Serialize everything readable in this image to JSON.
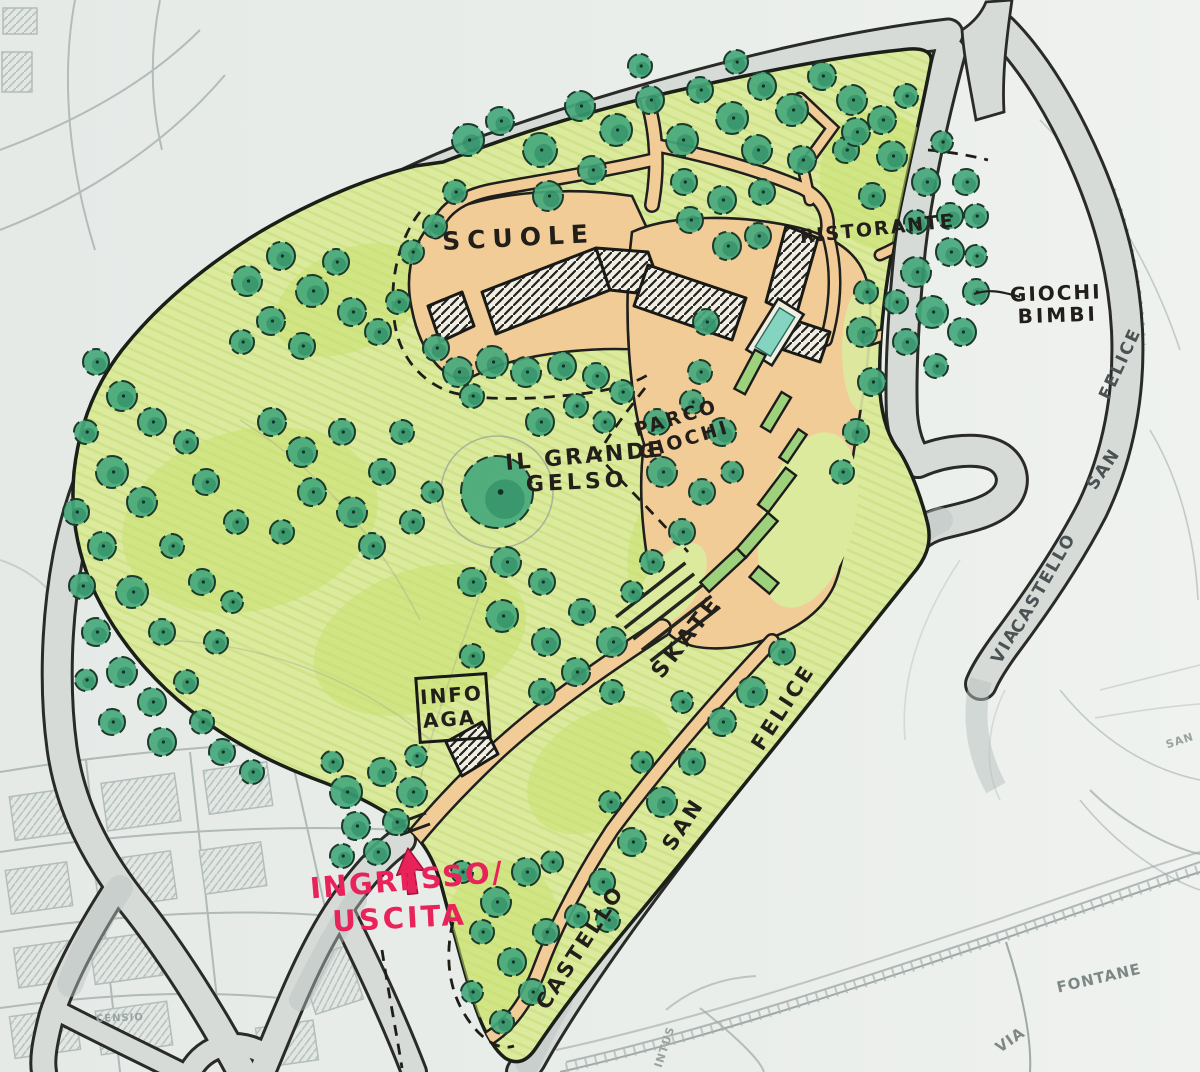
{
  "document": {
    "kind": "hand-drawn park masterplan sketch"
  },
  "palette": {
    "paper": "#e9ede9",
    "basemap_line": "#b2bcba",
    "road_fill": "#d6dbd8",
    "road_stroke": "#2a2a27",
    "park_lawn": "#dcea9e",
    "lawn_bright": "#c9e070",
    "tree_green": "#47a87c",
    "tree_dark": "#1f7f5b",
    "tree_outline": "#1c3a2b",
    "path_tan": "#f2cc97",
    "pool_teal": "#84d4c0",
    "ink": "#221f1a",
    "pencil": "#4a5254",
    "faint": "#7d8886",
    "fainter": "#98a3a0",
    "red": "#e7235a"
  },
  "labels": [
    {
      "id": "scuole",
      "text": "SCUOLE",
      "x": 519,
      "y": 246,
      "rot": -3,
      "size": 25,
      "ls": 7,
      "color": "ink"
    },
    {
      "id": "ristorante",
      "text": "RISTORANTE",
      "x": 878,
      "y": 235,
      "rot": -6,
      "size": 19,
      "ls": 2,
      "color": "ink"
    },
    {
      "id": "giochi-bimbi-line1",
      "text": "GIOCHI",
      "x": 1056,
      "y": 300,
      "rot": -2,
      "size": 20,
      "ls": 2,
      "color": "ink"
    },
    {
      "id": "giochi-bimbi-line2",
      "text": "BIMBI",
      "x": 1058,
      "y": 322,
      "rot": -2,
      "size": 20,
      "ls": 3,
      "color": "ink"
    },
    {
      "id": "parco-giochi-line1",
      "text": "PARCO",
      "x": 678,
      "y": 424,
      "rot": -17,
      "size": 19,
      "ls": 3,
      "color": "ink"
    },
    {
      "id": "parco-giochi-line2",
      "text": "GIOCHI",
      "x": 686,
      "y": 446,
      "rot": -17,
      "size": 19,
      "ls": 3,
      "color": "ink"
    },
    {
      "id": "il-grande-gelso-line1",
      "text": "IL GRANDE",
      "x": 586,
      "y": 463,
      "rot": -5,
      "size": 22,
      "ls": 3,
      "color": "ink"
    },
    {
      "id": "il-grande-gelso-line2",
      "text": "GELSO",
      "x": 577,
      "y": 489,
      "rot": -3,
      "size": 22,
      "ls": 4,
      "color": "ink"
    },
    {
      "id": "skate",
      "text": "SKATE",
      "x": 692,
      "y": 641,
      "rot": -52,
      "size": 22,
      "ls": 4,
      "color": "ink"
    },
    {
      "id": "info-aga-line1",
      "text": "INFO",
      "x": 452,
      "y": 702,
      "rot": -4,
      "size": 20,
      "ls": 2,
      "color": "ink"
    },
    {
      "id": "info-aga-line2",
      "text": "AGA",
      "x": 450,
      "y": 726,
      "rot": -4,
      "size": 20,
      "ls": 2,
      "color": "ink"
    },
    {
      "id": "ingresso",
      "text": "INGRESSO/",
      "x": 408,
      "y": 890,
      "rot": -5,
      "size": 29,
      "ls": 2,
      "color": "red"
    },
    {
      "id": "uscita",
      "text": "USCITA",
      "x": 400,
      "y": 928,
      "rot": -3,
      "size": 29,
      "ls": 3,
      "color": "red"
    },
    {
      "id": "road-castello",
      "text": "CASTELLO",
      "x": 586,
      "y": 951,
      "rot": -57,
      "size": 21,
      "ls": 3,
      "color": "ink"
    },
    {
      "id": "road-san",
      "text": "SAN",
      "x": 689,
      "y": 828,
      "rot": -57,
      "size": 21,
      "ls": 3,
      "color": "ink"
    },
    {
      "id": "road-felice",
      "text": "FELICE",
      "x": 789,
      "y": 711,
      "rot": -57,
      "size": 21,
      "ls": 3,
      "color": "ink"
    },
    {
      "id": "via-right",
      "text": "VIA",
      "x": 1010,
      "y": 648,
      "rot": -60,
      "size": 17,
      "ls": 2,
      "color": "pencil"
    },
    {
      "id": "castello-right",
      "text": "CASTELLO",
      "x": 1048,
      "y": 586,
      "rot": -60,
      "size": 17,
      "ls": 2,
      "color": "pencil"
    },
    {
      "id": "san-right",
      "text": "SAN",
      "x": 1108,
      "y": 472,
      "rot": -56,
      "size": 17,
      "ls": 2,
      "color": "pencil"
    },
    {
      "id": "felice-right",
      "text": "FELICE",
      "x": 1125,
      "y": 366,
      "rot": -65,
      "size": 17,
      "ls": 2,
      "color": "pencil"
    },
    {
      "id": "via-fontane-word1",
      "text": "VIA",
      "x": 1013,
      "y": 1044,
      "rot": -35,
      "size": 15,
      "ls": 1,
      "color": "faint"
    },
    {
      "id": "via-fontane-word2",
      "text": "FONTANE",
      "x": 1100,
      "y": 983,
      "rot": -13,
      "size": 15,
      "ls": 1,
      "color": "faint"
    },
    {
      "id": "san-basemap",
      "text": "SAN",
      "x": 1181,
      "y": 744,
      "rot": -18,
      "size": 11,
      "ls": 1,
      "color": "fainter"
    },
    {
      "id": "censio-basemap",
      "text": "CENSIO",
      "x": 120,
      "y": 1021,
      "rot": -2,
      "size": 10,
      "ls": 1,
      "color": "fainter"
    },
    {
      "id": "intus-basemap",
      "text": "INTUS",
      "x": 668,
      "y": 1048,
      "rot": -72,
      "size": 11,
      "ls": 1,
      "color": "fainter"
    }
  ],
  "trees": [
    [
      468,
      140,
      16
    ],
    [
      500,
      121,
      14
    ],
    [
      540,
      150,
      17
    ],
    [
      580,
      106,
      15
    ],
    [
      616,
      130,
      16
    ],
    [
      650,
      100,
      14
    ],
    [
      682,
      140,
      16
    ],
    [
      592,
      170,
      14
    ],
    [
      548,
      196,
      15
    ],
    [
      700,
      90,
      13
    ],
    [
      732,
      118,
      16
    ],
    [
      762,
      86,
      14
    ],
    [
      792,
      110,
      16
    ],
    [
      822,
      76,
      14
    ],
    [
      852,
      100,
      15
    ],
    [
      882,
      120,
      14
    ],
    [
      906,
      96,
      12
    ],
    [
      757,
      150,
      15
    ],
    [
      802,
      160,
      14
    ],
    [
      846,
      150,
      13
    ],
    [
      640,
      66,
      12
    ],
    [
      736,
      62,
      12
    ],
    [
      684,
      182,
      13
    ],
    [
      722,
      200,
      14
    ],
    [
      762,
      192,
      13
    ],
    [
      690,
      220,
      13
    ],
    [
      727,
      246,
      14
    ],
    [
      758,
      236,
      13
    ],
    [
      247,
      281,
      15
    ],
    [
      281,
      256,
      14
    ],
    [
      312,
      291,
      16
    ],
    [
      271,
      321,
      14
    ],
    [
      336,
      262,
      13
    ],
    [
      352,
      312,
      14
    ],
    [
      302,
      346,
      13
    ],
    [
      242,
      342,
      12
    ],
    [
      378,
      332,
      13
    ],
    [
      398,
      302,
      12
    ],
    [
      412,
      252,
      12
    ],
    [
      435,
      226,
      12
    ],
    [
      455,
      192,
      12
    ],
    [
      96,
      362,
      13
    ],
    [
      122,
      396,
      15
    ],
    [
      86,
      432,
      12
    ],
    [
      152,
      422,
      14
    ],
    [
      112,
      472,
      16
    ],
    [
      76,
      512,
      13
    ],
    [
      142,
      502,
      15
    ],
    [
      102,
      546,
      14
    ],
    [
      172,
      546,
      12
    ],
    [
      82,
      586,
      13
    ],
    [
      132,
      592,
      16
    ],
    [
      96,
      632,
      14
    ],
    [
      162,
      632,
      13
    ],
    [
      122,
      672,
      15
    ],
    [
      86,
      680,
      11
    ],
    [
      152,
      702,
      14
    ],
    [
      186,
      682,
      12
    ],
    [
      112,
      722,
      13
    ],
    [
      162,
      742,
      14
    ],
    [
      202,
      722,
      12
    ],
    [
      222,
      752,
      13
    ],
    [
      252,
      772,
      12
    ],
    [
      216,
      642,
      12
    ],
    [
      202,
      582,
      13
    ],
    [
      232,
      602,
      11
    ],
    [
      186,
      442,
      12
    ],
    [
      206,
      482,
      13
    ],
    [
      236,
      522,
      12
    ],
    [
      272,
      422,
      14
    ],
    [
      302,
      452,
      15
    ],
    [
      342,
      432,
      13
    ],
    [
      312,
      492,
      14
    ],
    [
      352,
      512,
      15
    ],
    [
      282,
      532,
      12
    ],
    [
      382,
      472,
      13
    ],
    [
      402,
      432,
      12
    ],
    [
      372,
      546,
      13
    ],
    [
      412,
      522,
      12
    ],
    [
      432,
      492,
      11
    ],
    [
      458,
      372,
      15
    ],
    [
      492,
      362,
      16
    ],
    [
      526,
      372,
      15
    ],
    [
      562,
      366,
      14
    ],
    [
      596,
      376,
      13
    ],
    [
      622,
      392,
      12
    ],
    [
      472,
      396,
      12
    ],
    [
      436,
      348,
      13
    ],
    [
      497,
      492,
      36
    ],
    [
      540,
      422,
      14
    ],
    [
      576,
      406,
      12
    ],
    [
      604,
      422,
      11
    ],
    [
      657,
      422,
      13
    ],
    [
      692,
      402,
      12
    ],
    [
      722,
      432,
      14
    ],
    [
      662,
      472,
      15
    ],
    [
      702,
      492,
      13
    ],
    [
      732,
      472,
      11
    ],
    [
      682,
      532,
      13
    ],
    [
      706,
      322,
      13
    ],
    [
      700,
      372,
      12
    ],
    [
      862,
      332,
      15
    ],
    [
      872,
      382,
      14
    ],
    [
      856,
      432,
      13
    ],
    [
      842,
      472,
      12
    ],
    [
      866,
      292,
      12
    ],
    [
      916,
      272,
      15
    ],
    [
      950,
      252,
      14
    ],
    [
      976,
      292,
      13
    ],
    [
      932,
      312,
      16
    ],
    [
      962,
      332,
      14
    ],
    [
      906,
      342,
      13
    ],
    [
      936,
      366,
      12
    ],
    [
      976,
      256,
      11
    ],
    [
      896,
      302,
      12
    ],
    [
      966,
      182,
      13
    ],
    [
      976,
      216,
      12
    ],
    [
      856,
      132,
      14
    ],
    [
      892,
      156,
      15
    ],
    [
      926,
      182,
      14
    ],
    [
      950,
      216,
      13
    ],
    [
      872,
      196,
      13
    ],
    [
      916,
      222,
      12
    ],
    [
      942,
      142,
      11
    ],
    [
      472,
      582,
      14
    ],
    [
      506,
      562,
      15
    ],
    [
      542,
      582,
      13
    ],
    [
      502,
      616,
      16
    ],
    [
      546,
      642,
      14
    ],
    [
      472,
      656,
      12
    ],
    [
      582,
      612,
      13
    ],
    [
      612,
      642,
      15
    ],
    [
      576,
      672,
      14
    ],
    [
      612,
      692,
      12
    ],
    [
      542,
      692,
      13
    ],
    [
      632,
      592,
      11
    ],
    [
      652,
      562,
      12
    ],
    [
      782,
      652,
      13
    ],
    [
      752,
      692,
      15
    ],
    [
      722,
      722,
      14
    ],
    [
      692,
      762,
      13
    ],
    [
      662,
      802,
      15
    ],
    [
      632,
      842,
      14
    ],
    [
      602,
      882,
      13
    ],
    [
      577,
      916,
      12
    ],
    [
      642,
      762,
      11
    ],
    [
      682,
      702,
      11
    ],
    [
      610,
      802,
      11
    ],
    [
      608,
      920,
      12
    ],
    [
      526,
      872,
      14
    ],
    [
      496,
      902,
      15
    ],
    [
      546,
      932,
      13
    ],
    [
      512,
      962,
      14
    ],
    [
      482,
      932,
      12
    ],
    [
      532,
      992,
      13
    ],
    [
      472,
      992,
      11
    ],
    [
      502,
      1022,
      12
    ],
    [
      552,
      862,
      11
    ],
    [
      462,
      872,
      11
    ],
    [
      346,
      792,
      16
    ],
    [
      382,
      772,
      14
    ],
    [
      412,
      792,
      15
    ],
    [
      356,
      826,
      14
    ],
    [
      396,
      822,
      13
    ],
    [
      342,
      856,
      12
    ],
    [
      377,
      852,
      13
    ],
    [
      332,
      762,
      11
    ],
    [
      416,
      756,
      11
    ]
  ]
}
